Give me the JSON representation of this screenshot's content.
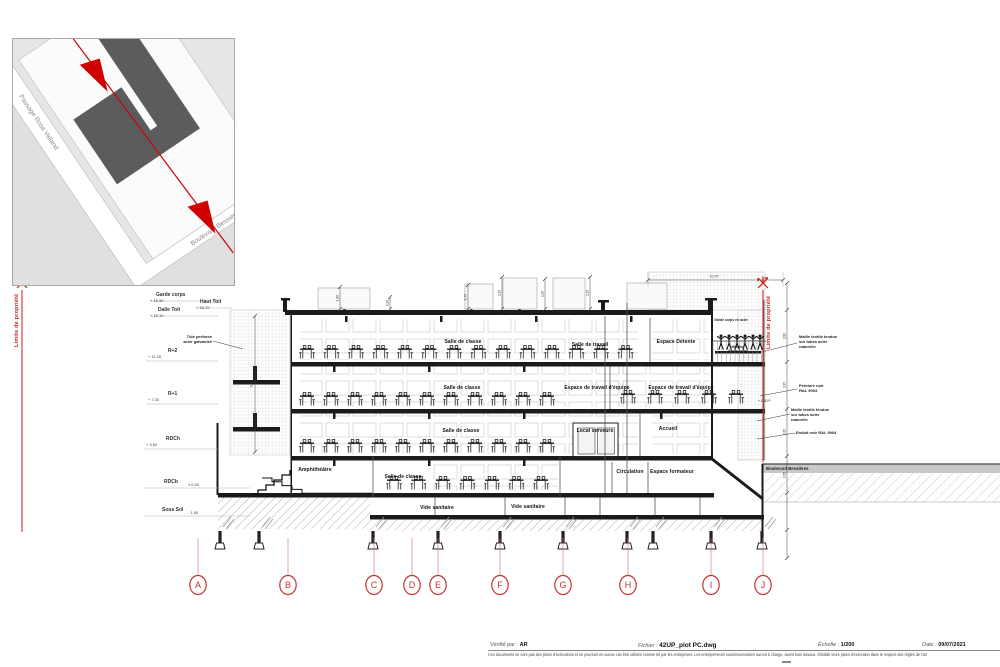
{
  "inset_map": {
    "street_left": "Passage Rosa Valland",
    "street_bottom": "Boulevard Bessières"
  },
  "limits": {
    "left": "Limite de propriété",
    "right": "Limite de propriété"
  },
  "levels": [
    {
      "name": "Garde corps",
      "elev": "+ 16,30"
    },
    {
      "name": "Haut Toit",
      "elev": "+ 15,70"
    },
    {
      "name": "Dalle Toit",
      "elev": "+ 15,10"
    },
    {
      "name": "R+2",
      "elev": "+ 11,00"
    },
    {
      "name": "R+1",
      "elev": "+ 7,30"
    },
    {
      "name": "RDCh",
      "elev": "+ 3,60"
    },
    {
      "name": "RDCb",
      "elev": "± 0,00"
    },
    {
      "name": "Sous Sol",
      "elev": "- 1,80"
    }
  ],
  "rooms": {
    "classroom": "Salle de classe",
    "work_room": "Salle de travail",
    "lounge": "Espace Détente",
    "team_space": "Espace de travail d'équipe",
    "server_room": "Local serveurs",
    "reception": "Accueil",
    "amphitheatre": "Amphithéâtre",
    "circulation": "Circulation",
    "trainer_space": "Espace formateur",
    "crawl_space": "Vide sanitaire"
  },
  "annotations": {
    "left_facade": "Tôle perforée\nacier galvanisé",
    "roof_railing": "Garde corps en acier",
    "roof_furniture": "Mobilier\nGarde corps",
    "mesh_top": "Maille textile tendue\nsur tubes acier\nnaturelle",
    "paint": "Peinture noir\nRAL 9004",
    "mesh_bottom": "Maille textile tendue\nsur tubes acier\nnaturelle",
    "coating": "Enduit noir RAL 9004",
    "level_p": "+ 1,00 P",
    "street_right": "Boulevard Bessières"
  },
  "dimensions": {
    "top_width": "10,70",
    "screen_height": "9,80",
    "verticals": [
      "1,60",
      "0,90",
      "1,75",
      "2,35",
      "2,20",
      "2,35"
    ],
    "right_ticks": [
      "2,80",
      "3,35",
      "3,35",
      "3,35"
    ]
  },
  "grid_axes": [
    "A",
    "B",
    "C",
    "D",
    "E",
    "F",
    "G",
    "H",
    "I",
    "J"
  ],
  "titleblock": {
    "verified_label": "Vérifié par :",
    "verified_value": "AR",
    "file_label": "Fichier :",
    "file_value": "42UP_plot PC.dwg",
    "scale_label": "Échelle :",
    "scale_value": "1/200",
    "date_label": "Date :",
    "date_value": "09/07/2021",
    "disclaimer": "Ces documents ne sont pas des plans d'exécutions et ne pourront en aucun cas être utilisés comme tel par les entreprises. Les entrepreneurs soumissionnaires auront à charge, avant tous travaux, d'établir leurs plans d'exécution dans le respect des règles de l'art"
  },
  "colors": {
    "accent_red": "#c41a1a",
    "building_dark": "#5c5c5c",
    "block_gray": "#e0e0e0"
  }
}
